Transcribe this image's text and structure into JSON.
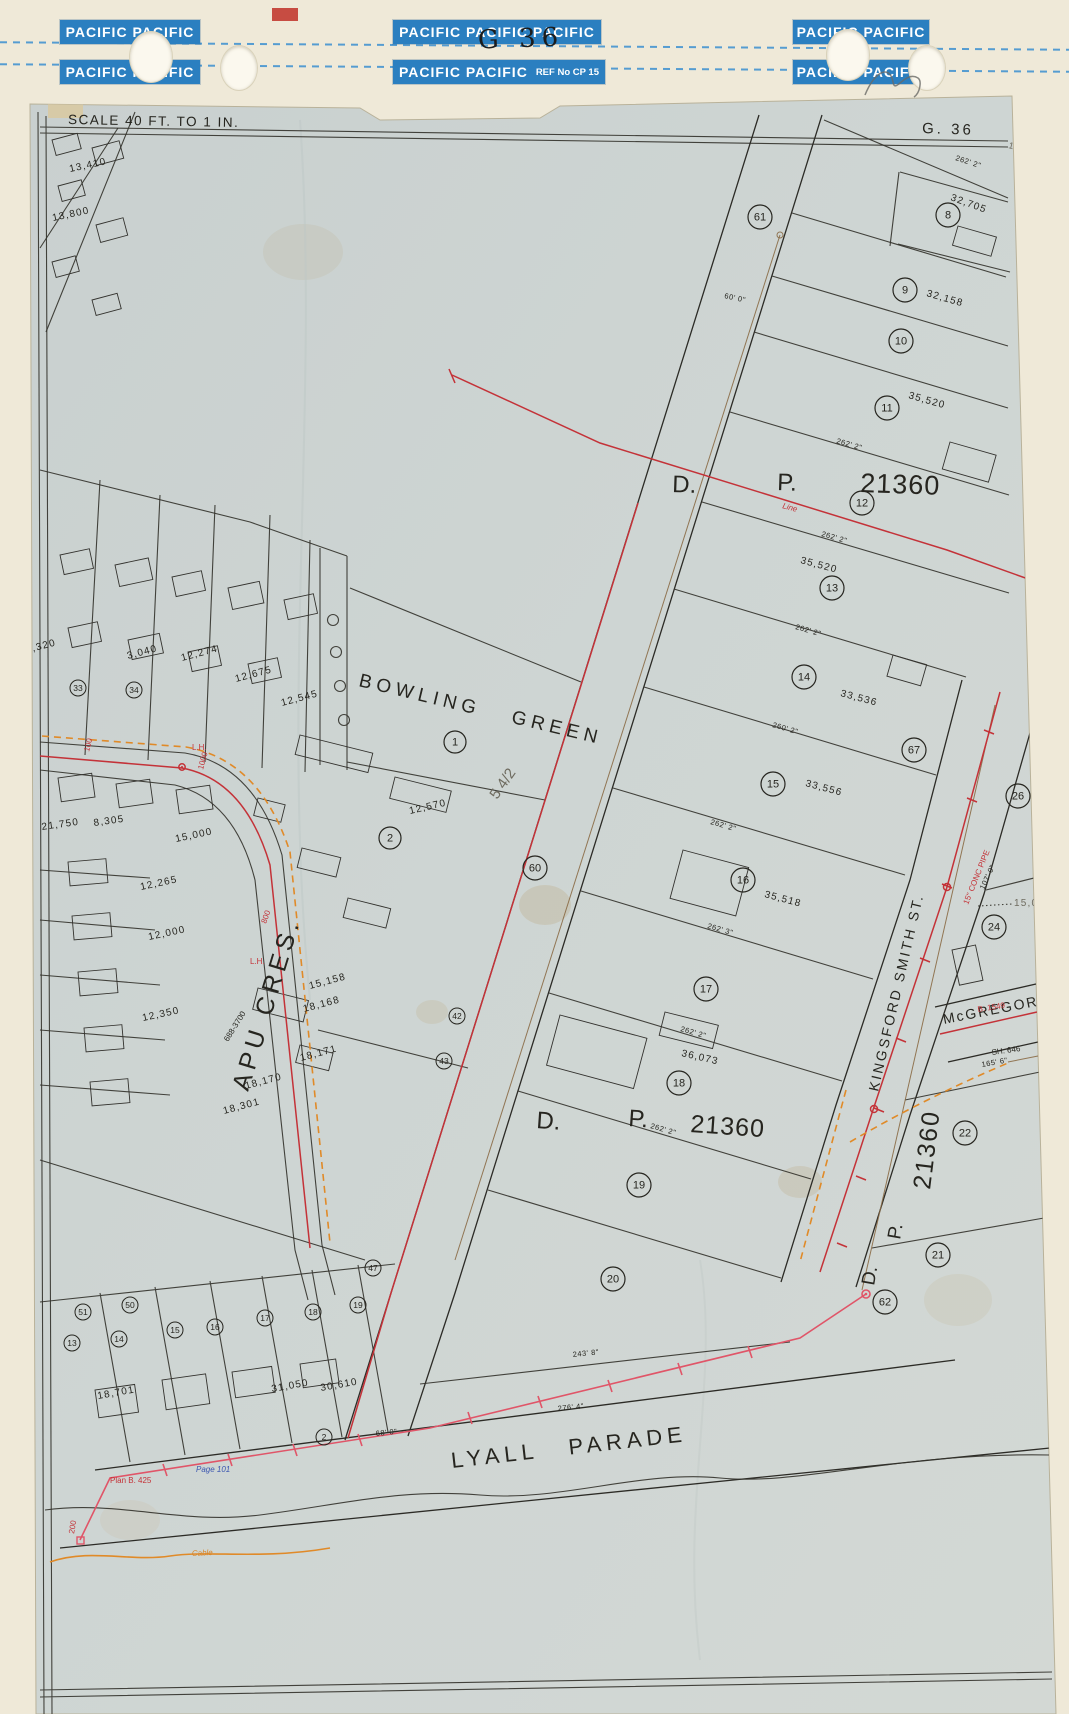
{
  "header": {
    "strips": [
      "PACIFIC PACIFIC",
      "PACIFIC PACIFIC PACIFIC",
      "PACIFIC PACIFIC",
      "PACIFIC PACIFIC",
      "PACIFIC PACIFIC",
      "PACIFIC PACIFIC"
    ],
    "ref_label": "REF No CP 15",
    "sheet_code_handwritten": "G 36",
    "accent_blue": "#2b7fc0"
  },
  "map": {
    "scale_label": "SCALE 40 FT. TO 1 IN.",
    "sheet_ref": "G. 36",
    "streets": {
      "bowling": "BOWLING GREEN",
      "apu": "APU CRES.",
      "lyall": "LYALL  PARADE",
      "kingsford": "KINGSFORD SMITH ST.",
      "mcgregor": "McGREGOR ST"
    },
    "dp": {
      "d": "D.",
      "p": "P.",
      "num": "21360"
    },
    "lots": [
      "1",
      "2",
      "8",
      "9",
      "10",
      "11",
      "12",
      "13",
      "14",
      "15",
      "16",
      "17",
      "18",
      "19",
      "20",
      "21",
      "22",
      "24",
      "26",
      "60",
      "61",
      "62",
      "67",
      "33",
      "34",
      "42",
      "43",
      "47",
      "50",
      "51",
      "13",
      "14",
      "15",
      "16",
      "17",
      "18",
      "19",
      "2"
    ],
    "areas": [
      "32,705",
      "32,158",
      "35,520",
      "35,520",
      "33,536",
      "33,556",
      "35,518",
      "36,073",
      "15,000",
      "13,410",
      "13,800",
      "12,320",
      "3,040",
      "12,274",
      "12,675",
      "12,545",
      "12,570",
      "21,750",
      "8,305",
      "15,000",
      "12,265",
      "12,000",
      "12,350",
      "15,158",
      "18,168",
      "18,171",
      "18,170",
      "18,301",
      "18,701",
      "31,050",
      "30,610"
    ],
    "dims": [
      "262' 2\"",
      "262' 2\"",
      "262' 2\"",
      "262' 2\"",
      "260' 2\"",
      "262' 2\"",
      "262' 3\"",
      "262' 2\"",
      "262' 2\"",
      "243' 8\"",
      "276' 4\"",
      "68' 0\"",
      "60' 0\"",
      "107' 0\"",
      "165' 6\""
    ],
    "notes": {
      "page": "Page 101",
      "plan": "Plan B. 425",
      "lh1": "L.H.",
      "lh2": "L.H.",
      "n800": "800",
      "n1000": "1000",
      "n100": "100",
      "n200": "200",
      "phone": "688-3700",
      "pipe": "15\" CONC PIPE",
      "b1549": "B. 1549",
      "sh646": "SH. 646",
      "cable": "Cable",
      "pencil_value": "14,000",
      "sketch": "5 4/2",
      "line_mark": "Line"
    },
    "colors": {
      "ink": "#35342e",
      "survey_red": "#c43238",
      "survey_pink": "#e05568",
      "utility_orange": "#e08a28",
      "utility_sepia": "#8a6a45",
      "note_blue": "#3a55b0",
      "sheet": "#ccd3d1",
      "backing": "#efe9d8"
    }
  }
}
